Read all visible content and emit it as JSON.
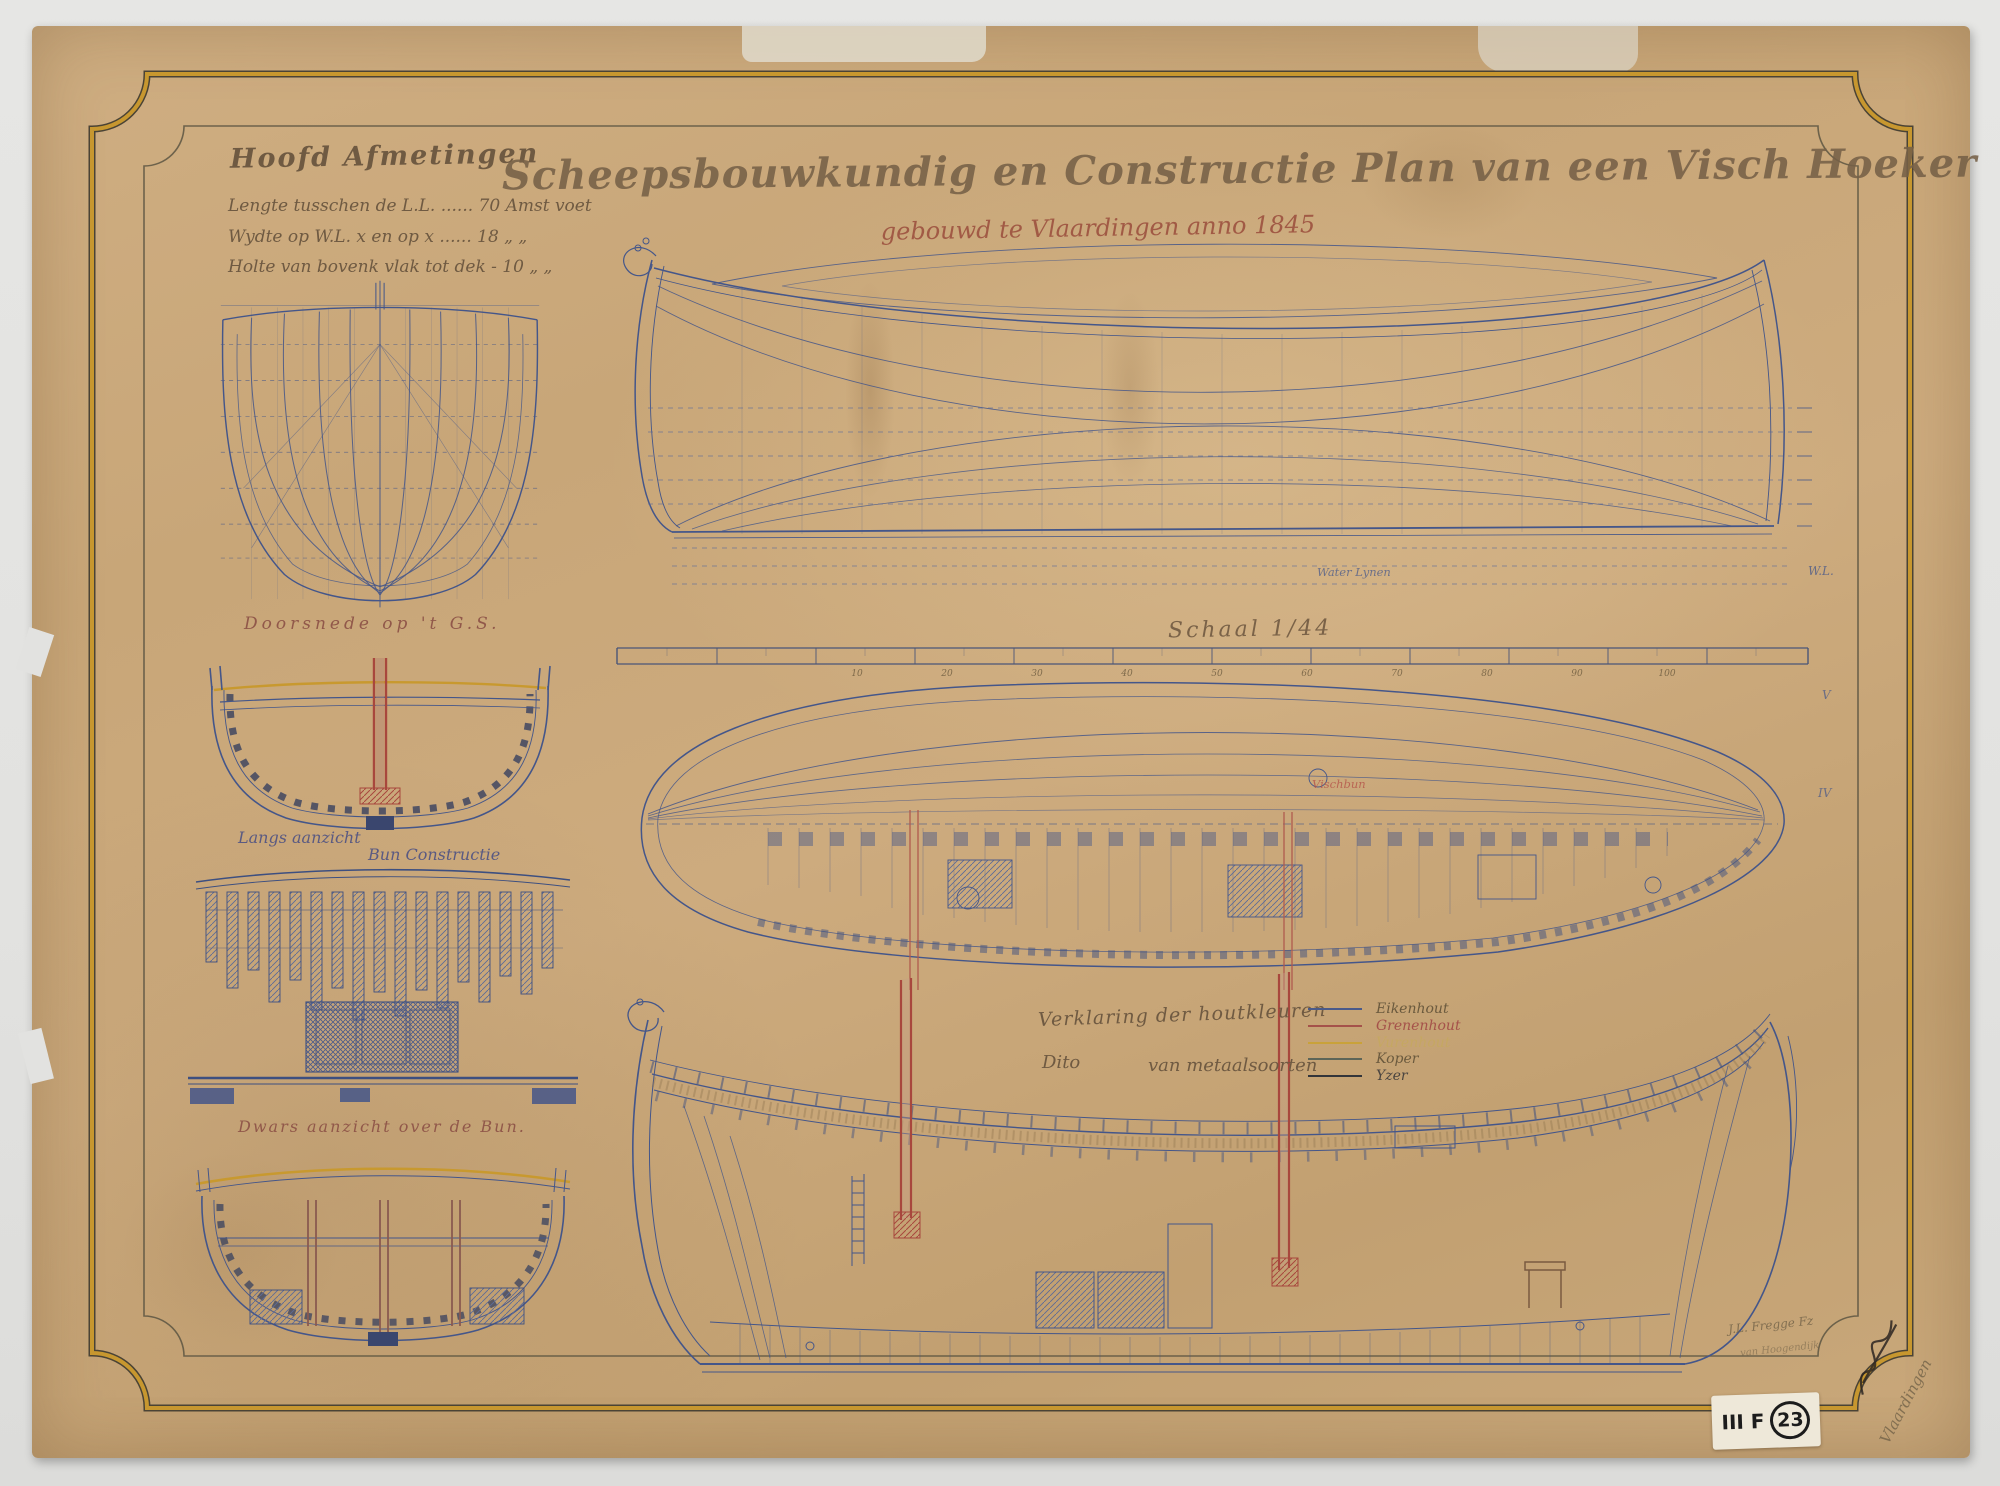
{
  "palette": {
    "paper": "#c9a87b",
    "ink_blue": "#44568a",
    "ink_faded_blue": "#7581a8",
    "ink_red": "#a8473d",
    "ink_yellow": "#c8992f",
    "ink_brown": "#6f5a42",
    "frame_gold": "#c7972f"
  },
  "header": {
    "dimensions_title": "Hoofd Afmetingen",
    "dimension_lines": [
      "Lengte tusschen de L.L. ...... 70 Amst voet",
      "Wydte op W.L. x en op x ...... 18  „      „",
      "Holte van bovenk vlak tot dek - 10  „      „"
    ],
    "main_title": "Scheepsbouwkundig en Constructie Plan van een Visch Hoeker",
    "subtitle": "gebouwd te Vlaardingen anno 1845"
  },
  "views": {
    "doorsnede_label": "Doorsnede op 't G.S.",
    "langs_label_left": "Langs aanzicht",
    "langs_label_right": "Bun Constructie",
    "dwars_label": "Dwars aanzicht over de Bun.",
    "schaal_label": "Schaal 1/44",
    "water_lines_label": "Water Lynen",
    "vischbun_label": "Vischbun",
    "wl_mark": "W.L.",
    "right_marks": [
      "V",
      "IV"
    ]
  },
  "scale_bar": {
    "ticks": [
      "10",
      "20",
      "30",
      "40",
      "50",
      "60",
      "70",
      "80",
      "90",
      "100"
    ]
  },
  "legend": {
    "title_wood": "Verklaring der houtkleuren",
    "title_metal_left": "Dito",
    "title_metal_right": "van metaalsoorten",
    "entries": [
      {
        "label": "Eikenhout",
        "color": "#4a5a8a",
        "label_color": "#6b5a3e"
      },
      {
        "label": "Grenenhout",
        "color": "#a5524a",
        "label_color": "#a5524a"
      },
      {
        "label": "Vurenhout",
        "color": "#c9a23a",
        "label_color": "#c6a95e"
      },
      {
        "label": "Koper",
        "color": "#5d6558",
        "label_color": "#6b5a3e"
      },
      {
        "label": "Yzer",
        "color": "#33353a",
        "label_color": "#4a4440"
      }
    ]
  },
  "annotations": {
    "stamp_prefix": "III F",
    "stamp_number": "23",
    "pencil_note": "J.L. Fregge Fz",
    "pencil_note2": "van Hoogendijk",
    "pencil_corner": "Vlaardingen"
  }
}
